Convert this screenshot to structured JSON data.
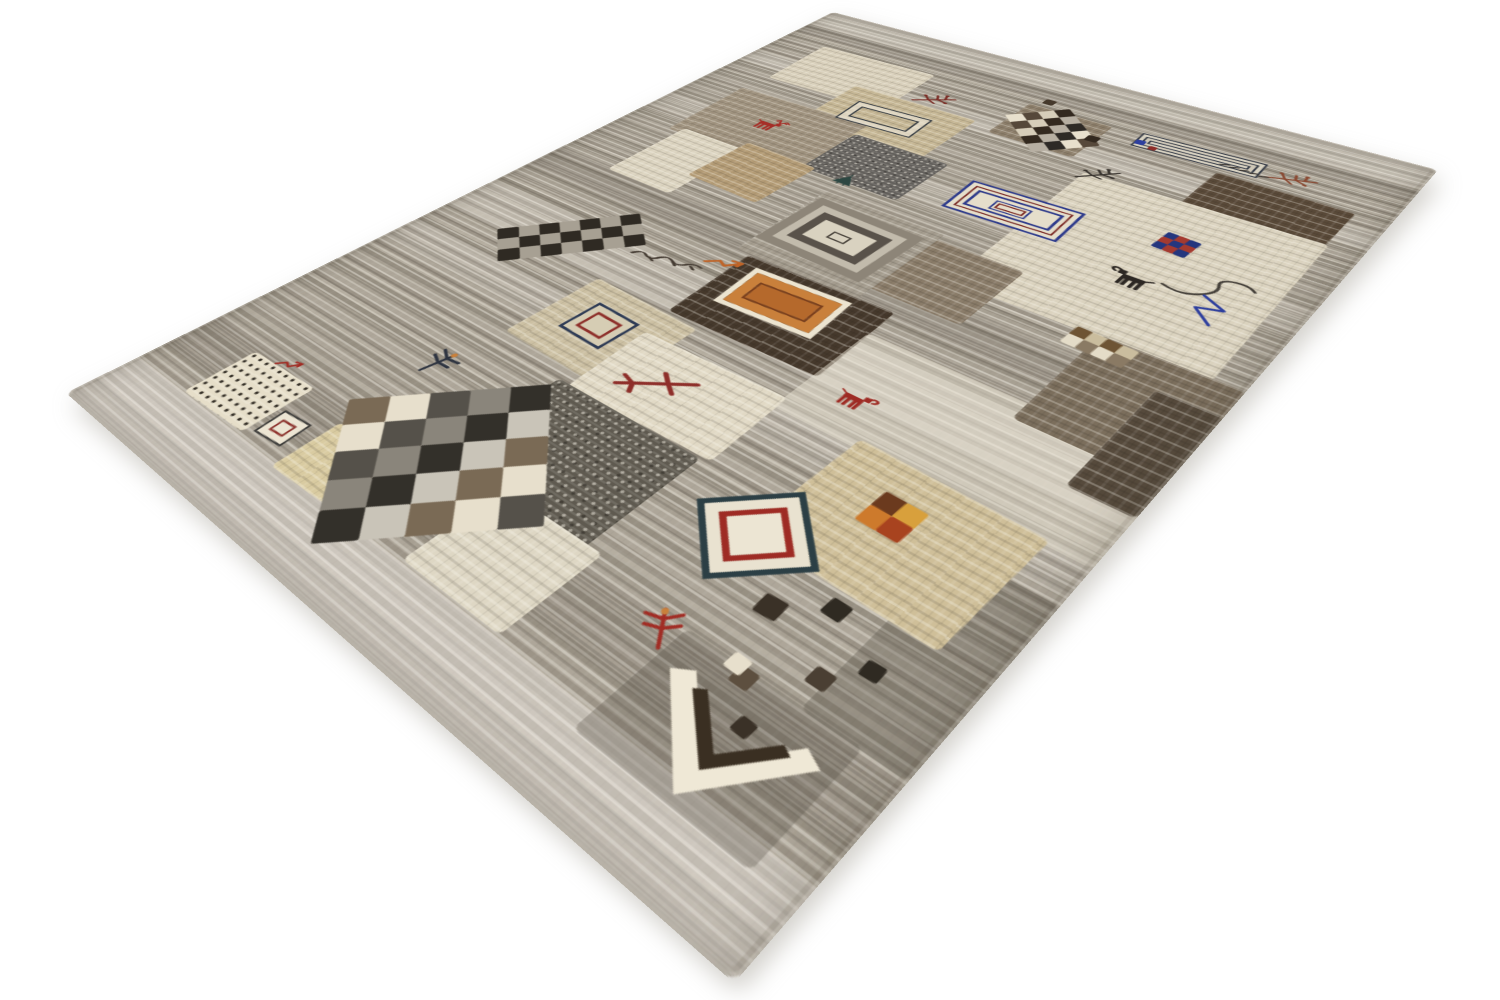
{
  "image": {
    "subject": "Hand-knotted Persian Gabbeh patchwork wool rug on a white background",
    "view": "angled floor perspective, near corner pointing toward viewer",
    "background_color": "#ffffff"
  },
  "palette": {
    "ground_gray": "#a39b8d",
    "ivory": "#e7dfcc",
    "cream": "#dbd3bf",
    "beige": "#cfbf99",
    "tan": "#b49c76",
    "brown": "#8a7c69",
    "dark_brown": "#46392c",
    "charcoal": "#2c2723",
    "rust_red": "#a12c24",
    "wine_red": "#8e2f2a",
    "orange": "#c9803b",
    "navy": "#2e3b8c",
    "royal_blue": "#2e3f9e",
    "teal": "#2c3f45",
    "deep_teal": "#2d4742"
  },
  "rug": {
    "silhouette_corners_px": {
      "top": [
        833,
        12
      ],
      "right": [
        1438,
        170
      ],
      "bottom": [
        734,
        983
      ],
      "left": [
        66,
        393
      ]
    },
    "flat_design_units": {
      "width": 700,
      "height": 1000
    },
    "base": {
      "color": "#a39b8d"
    },
    "bands": [
      {
        "name": "band-top-light",
        "y": 0,
        "h": 48,
        "color": "rgba(250,246,236,0.32)"
      },
      {
        "name": "band-top-dark",
        "y": 48,
        "h": 26,
        "color": "rgba(88,82,72,0.16)"
      },
      {
        "name": "band-upper-light",
        "y": 148,
        "h": 34,
        "color": "rgba(252,248,238,0.26)"
      },
      {
        "name": "band-mid-light",
        "y": 298,
        "h": 38,
        "color": "rgba(250,246,236,0.20)"
      },
      {
        "name": "band-mid-dark",
        "y": 468,
        "h": 44,
        "color": "rgba(80,74,64,0.14)"
      },
      {
        "name": "band-center-light",
        "y": 556,
        "h": 62,
        "color": "rgba(252,248,238,0.24)"
      },
      {
        "name": "band-lower-light",
        "y": 652,
        "h": 40,
        "color": "rgba(250,246,236,0.18)"
      },
      {
        "name": "band-bottom-dark",
        "y": 862,
        "h": 52,
        "color": "rgba(64,58,48,0.12)"
      },
      {
        "name": "band-bottom-light",
        "y": 938,
        "h": 62,
        "color": "rgba(250,246,240,0.42)"
      }
    ],
    "patches": [
      {
        "name": "patch-cream-top",
        "x": 60,
        "y": 92,
        "w": 152,
        "h": 108,
        "color": "#d9d0bb",
        "rot": -2
      },
      {
        "name": "patch-brown-by-checkerboard",
        "x": 330,
        "y": 92,
        "w": 94,
        "h": 84,
        "color": "#8d7f6b"
      },
      {
        "name": "patch-beige-frame",
        "x": 156,
        "y": 162,
        "w": 152,
        "h": 108,
        "color": "#c6b795",
        "rot": -1
      },
      {
        "name": "patch-taupe-deer",
        "x": 58,
        "y": 238,
        "w": 168,
        "h": 126,
        "color": "#a0937f",
        "rot": -2
      },
      {
        "name": "patch-speckled-slate",
        "x": 226,
        "y": 260,
        "w": 112,
        "h": 90,
        "color": "#63605c",
        "speckled": true
      },
      {
        "name": "patch-dark-brown-right",
        "x": 544,
        "y": 124,
        "w": 126,
        "h": 90,
        "color": "#5a4a39",
        "rot": 1
      },
      {
        "name": "patch-cream-field-right",
        "x": 450,
        "y": 194,
        "w": 224,
        "h": 240,
        "color": "#dbd3bf",
        "rot": -1
      },
      {
        "name": "patch-brown-mid",
        "x": 374,
        "y": 386,
        "w": 120,
        "h": 100,
        "color": "#8a7c69"
      },
      {
        "name": "patch-gray-frame",
        "x": 276,
        "y": 374,
        "w": 132,
        "h": 132,
        "color": "#a49c8e"
      },
      {
        "name": "patch-cream-left",
        "x": 74,
        "y": 356,
        "w": 84,
        "h": 114,
        "color": "#dcd4c0"
      },
      {
        "name": "patch-tan-left",
        "x": 148,
        "y": 342,
        "w": 90,
        "h": 90,
        "color": "#b49c76",
        "rot": 2
      },
      {
        "name": "patch-chocolate",
        "x": 294,
        "y": 506,
        "w": 152,
        "h": 108,
        "color": "#46392c",
        "rot": -2
      },
      {
        "name": "patch-beige-ring",
        "x": 212,
        "y": 620,
        "w": 120,
        "h": 104,
        "color": "#ccc0a3",
        "rot": 2
      },
      {
        "name": "patch-cream-arrow",
        "x": 304,
        "y": 648,
        "w": 144,
        "h": 90,
        "color": "#e1d9c5",
        "rot": -2
      },
      {
        "name": "patch-dark-gray-low",
        "x": 294,
        "y": 738,
        "w": 148,
        "h": 124,
        "color": "#5f5a50",
        "speckled": true
      },
      {
        "name": "patch-light-field",
        "x": 444,
        "y": 540,
        "w": 256,
        "h": 120,
        "color": "rgba(233,227,212,0.50)",
        "flat": true
      },
      {
        "name": "patch-brown-right-mid",
        "x": 586,
        "y": 430,
        "w": 114,
        "h": 132,
        "color": "#7b6e5c"
      },
      {
        "name": "patch-dark-right-edge",
        "x": 650,
        "y": 468,
        "w": 50,
        "h": 134,
        "color": "#564a3c"
      },
      {
        "name": "patch-gray-bottom-right",
        "x": 628,
        "y": 700,
        "w": 72,
        "h": 160,
        "color": "rgba(95,88,78,0.35)",
        "flat": true
      },
      {
        "name": "patch-gray-by-angle",
        "x": 540,
        "y": 858,
        "w": 130,
        "h": 95,
        "color": "rgba(90,84,74,0.30)",
        "flat": true
      },
      {
        "name": "patch-beige-bottom",
        "x": 514,
        "y": 652,
        "w": 152,
        "h": 122,
        "color": "#cfbf99",
        "rot": 2
      },
      {
        "name": "patch-pale-yellow",
        "x": 206,
        "y": 878,
        "w": 86,
        "h": 62,
        "color": "#d9cba1",
        "rot": -2
      },
      {
        "name": "patch-cream-below-checker",
        "x": 358,
        "y": 848,
        "w": 98,
        "h": 88,
        "color": "#ded7c4"
      },
      {
        "name": "patch-dots",
        "x": 72,
        "y": 870,
        "w": 82,
        "h": 66,
        "color": "#e6dec9",
        "dots": true,
        "rot": -2
      }
    ],
    "motifs": [
      {
        "name": "checkerboard-top",
        "type": "checker",
        "cx": 378,
        "cy": 134,
        "cols": 5,
        "rows": 4,
        "cell": 17,
        "rot": 42,
        "darks": [
          "#33291f",
          "#56483a",
          "#2e2a26"
        ],
        "lights": [
          "#e8e0cd",
          "#b7afa2",
          "#d6cdb9"
        ]
      },
      {
        "name": "checkerboard-band-left",
        "type": "checker",
        "cx": 142,
        "cy": 584,
        "cols": 3,
        "rows": 7,
        "cell": 19,
        "rot": 40,
        "darks": [
          "#2f2a23",
          "#6a5d4c"
        ],
        "lights": [
          "#e3dbc8",
          "#a7a093"
        ]
      },
      {
        "name": "checkerboard-large",
        "type": "checker",
        "cx": 296,
        "cy": 856,
        "cols": 5,
        "rows": 5,
        "cell": 31,
        "rot": 44,
        "darks": [
          "#33302a",
          "#55514a",
          "#7a6a55"
        ],
        "lights": [
          "#e7dfcc",
          "#c9c4b8",
          "#8a857b"
        ]
      },
      {
        "name": "checker-fragment",
        "type": "checker",
        "cx": 592,
        "cy": 444,
        "cols": 4,
        "rows": 2,
        "cell": 13,
        "rot": 3,
        "darks": [
          "#6e5434",
          "#8a7a64"
        ],
        "lights": [
          "#e4dcc8",
          "#cabd9e"
        ]
      },
      {
        "name": "pixel-square",
        "type": "checker",
        "cx": 572,
        "cy": 268,
        "cols": 3,
        "rows": 3,
        "cell": 10,
        "rot": 4,
        "darks": [
          "#24367e",
          "#8e2f2a"
        ],
        "lights": [
          "#3a4f9e",
          "#a43a30"
        ]
      },
      {
        "name": "four-square",
        "type": "checker",
        "cx": 578,
        "cy": 700,
        "cols": 2,
        "rows": 2,
        "cell": 17,
        "rot": 2,
        "darks": [
          "#6b3a1e",
          "#a8431f"
        ],
        "lights": [
          "#cd7a2c",
          "#d8a03c"
        ]
      },
      {
        "name": "striped-rectangle",
        "type": "rings",
        "cx": 516,
        "cy": 100,
        "w": 122,
        "h": 32,
        "rot": -3,
        "rings": [
          [
            "#343a46",
            2
          ],
          [
            "#d8d2c2",
            4
          ],
          [
            "#343a46",
            2
          ],
          [
            "#cfc8b8",
            4
          ],
          [
            "#3a404c",
            2
          ]
        ],
        "center": "#d8d2c2"
      },
      {
        "name": "double-rectangle",
        "type": "rings",
        "cx": 228,
        "cy": 214,
        "w": 90,
        "h": 48,
        "rot": -4,
        "rings": [
          [
            "#333a42",
            2
          ],
          [
            "rgba(238,232,218,0.65)",
            8
          ],
          [
            "#333a42",
            2
          ]
        ],
        "center": "transparent"
      },
      {
        "name": "labyrinth-rectangle",
        "type": "rings",
        "cx": 432,
        "cy": 300,
        "w": 114,
        "h": 60,
        "rot": -3,
        "rings": [
          [
            "#2e3b8c",
            3
          ],
          [
            "#e5decb",
            5
          ],
          [
            "#7c2b26",
            2
          ],
          [
            "#e5decb",
            4
          ],
          [
            "#2e3b8c",
            3
          ]
        ],
        "center": "#e5decb"
      },
      {
        "name": "labyrinth-core",
        "type": "rings",
        "cx": 430,
        "cy": 301,
        "w": 36,
        "h": 18,
        "rot": -3,
        "rings": [
          [
            "#2e3b8c",
            2
          ],
          [
            "#e5decb",
            2
          ],
          [
            "#7c2b26",
            2
          ]
        ],
        "center": "#e5decb"
      },
      {
        "name": "gray-concentric",
        "type": "rings",
        "cx": 337,
        "cy": 436,
        "w": 118,
        "h": 94,
        "rot": 2,
        "rings": [
          [
            "#8d8578",
            11
          ],
          [
            "#c2bbac",
            9
          ],
          [
            "#59524a",
            10
          ]
        ],
        "center": "#d9d2c0"
      },
      {
        "name": "gray-concentric-core",
        "type": "rings",
        "cx": 337,
        "cy": 436,
        "w": 20,
        "h": 13,
        "rot": 2,
        "rings": [
          [
            "#4a443c",
            2
          ]
        ],
        "center": "#d9d2c0"
      },
      {
        "name": "orange-rectangle",
        "type": "rings",
        "cx": 362,
        "cy": 548,
        "w": 98,
        "h": 62,
        "rot": -4,
        "rings": [
          [
            "#ece4d0",
            6
          ],
          [
            "#c9803b",
            11
          ],
          [
            "#7c3f1c",
            2
          ]
        ],
        "center": "#b5692c"
      },
      {
        "name": "navy-red-square",
        "type": "rings",
        "cx": 266,
        "cy": 668,
        "w": 50,
        "h": 46,
        "rot": 3,
        "rings": [
          [
            "#2e3b55",
            3
          ],
          [
            "#d6cdb4",
            7
          ],
          [
            "#8e2f2a",
            3
          ]
        ],
        "center": "#d6cdb4"
      },
      {
        "name": "diamond-rings",
        "type": "rings",
        "cx": 520,
        "cy": 770,
        "w": 74,
        "h": 74,
        "rot": 45,
        "rings": [
          [
            "#2c3f45",
            5
          ],
          [
            "#e9e2d0",
            9
          ],
          [
            "#9e2b24",
            5
          ]
        ],
        "center": "#ece5d3"
      },
      {
        "name": "small-red-square",
        "type": "rings",
        "cx": 176,
        "cy": 912,
        "w": 32,
        "h": 30,
        "rot": -5,
        "rings": [
          [
            "#3a3a38",
            2
          ],
          [
            "#ece5d3",
            6
          ],
          [
            "#8e2f2a",
            2
          ]
        ],
        "center": "#ece5d3"
      },
      {
        "name": "deer-red",
        "type": "glyph",
        "glyph": "deer",
        "cx": 142,
        "cy": 295,
        "w": 44,
        "h": 32,
        "rot": 0,
        "color": "#a62f28"
      },
      {
        "name": "goat-black",
        "type": "glyph",
        "glyph": "goat",
        "cx": 566,
        "cy": 342,
        "w": 44,
        "h": 30,
        "rot": 0,
        "color": "#2c2723",
        "flip": true
      },
      {
        "name": "goat-red",
        "type": "glyph",
        "glyph": "goat",
        "cx": 487,
        "cy": 615,
        "w": 36,
        "h": 25,
        "rot": 0,
        "color": "#9e2b24"
      },
      {
        "name": "dragonfly",
        "type": "glyph",
        "glyph": "dragonfly",
        "cx": 202,
        "cy": 785,
        "w": 30,
        "h": 36,
        "rot": 12,
        "color": "#2e3440"
      },
      {
        "name": "insect-red",
        "type": "glyph",
        "glyph": "dragonfly",
        "cx": 528,
        "cy": 868,
        "w": 30,
        "h": 34,
        "rot": -35,
        "color": "#a12c24"
      },
      {
        "name": "twig-red",
        "type": "glyph",
        "glyph": "twig",
        "cx": 246,
        "cy": 142,
        "w": 48,
        "h": 36,
        "rot": 0,
        "color": "#7c2f28"
      },
      {
        "name": "twig-rust",
        "type": "glyph",
        "glyph": "twig",
        "cx": 606,
        "cy": 96,
        "w": 46,
        "h": 34,
        "rot": 14,
        "color": "#8a4a33"
      },
      {
        "name": "twig-dark",
        "type": "glyph",
        "glyph": "twig",
        "cx": 462,
        "cy": 192,
        "w": 46,
        "h": 32,
        "rot": -12,
        "color": "#38332e"
      },
      {
        "name": "arrow-branch",
        "type": "glyph",
        "glyph": "birdfoot",
        "cx": 357,
        "cy": 696,
        "w": 66,
        "h": 50,
        "rot": 0,
        "color": "#8e2f2a"
      },
      {
        "name": "zigzag-arrow",
        "type": "glyph",
        "glyph": "zigarrow",
        "cx": 286,
        "cy": 530,
        "w": 42,
        "h": 28,
        "rot": -6,
        "color": "#bf6428"
      },
      {
        "name": "zigzag-arrow-small",
        "type": "glyph",
        "glyph": "zigarrow",
        "cx": 110,
        "cy": 862,
        "w": 28,
        "h": 20,
        "rot": -10,
        "color": "#a12c24"
      },
      {
        "name": "signature-scribble",
        "type": "glyph",
        "glyph": "scribble",
        "cx": 240,
        "cy": 560,
        "w": 74,
        "h": 32,
        "rot": -8,
        "color": "#453c33"
      },
      {
        "name": "knot-marks",
        "type": "glyph",
        "glyph": "marks",
        "cx": 564,
        "cy": 106,
        "w": 52,
        "h": 18,
        "rot": 6,
        "color": "#38332e"
      },
      {
        "name": "tree-bird",
        "type": "glyph",
        "glyph": "tree",
        "cx": 277,
        "cy": 345,
        "w": 26,
        "h": 24,
        "rot": 0,
        "color": "#2d4742"
      },
      {
        "name": "hook-line",
        "type": "glyph",
        "glyph": "hook",
        "cx": 622,
        "cy": 316,
        "w": 66,
        "h": 62,
        "rot": 8,
        "color": "#45403a"
      },
      {
        "name": "zigzag-line-blue",
        "type": "glyph",
        "glyph": "zigline",
        "cx": 634,
        "cy": 348,
        "w": 36,
        "h": 44,
        "rot": 0,
        "color": "#2e3f9e"
      },
      {
        "name": "angle-motif",
        "type": "glyph",
        "glyph": "angle",
        "cx": 608,
        "cy": 909,
        "w": 104,
        "h": 82,
        "rot": -6,
        "color": "#3a2f22"
      },
      {
        "name": "scatter-squares",
        "type": "squares",
        "cells": [
          [
            567,
            812,
            17,
            "#3a3127"
          ],
          [
            599,
            788,
            15,
            "#2f2a22"
          ],
          [
            624,
            836,
            14,
            "#4a3f33"
          ],
          [
            590,
            864,
            14,
            "#5d4f3f"
          ],
          [
            643,
            812,
            13,
            "#2f2a22"
          ],
          [
            612,
            890,
            12,
            "#3a3127"
          ],
          [
            580,
            858,
            13,
            "#e7dfcc"
          ],
          [
            345,
            78,
            12,
            "#45392c"
          ],
          [
            420,
            128,
            13,
            "#33291f"
          ],
          [
            461,
            108,
            10,
            "#2e3f9e"
          ],
          [
            476,
            113,
            8,
            "#8e2f2a"
          ]
        ]
      }
    ]
  }
}
